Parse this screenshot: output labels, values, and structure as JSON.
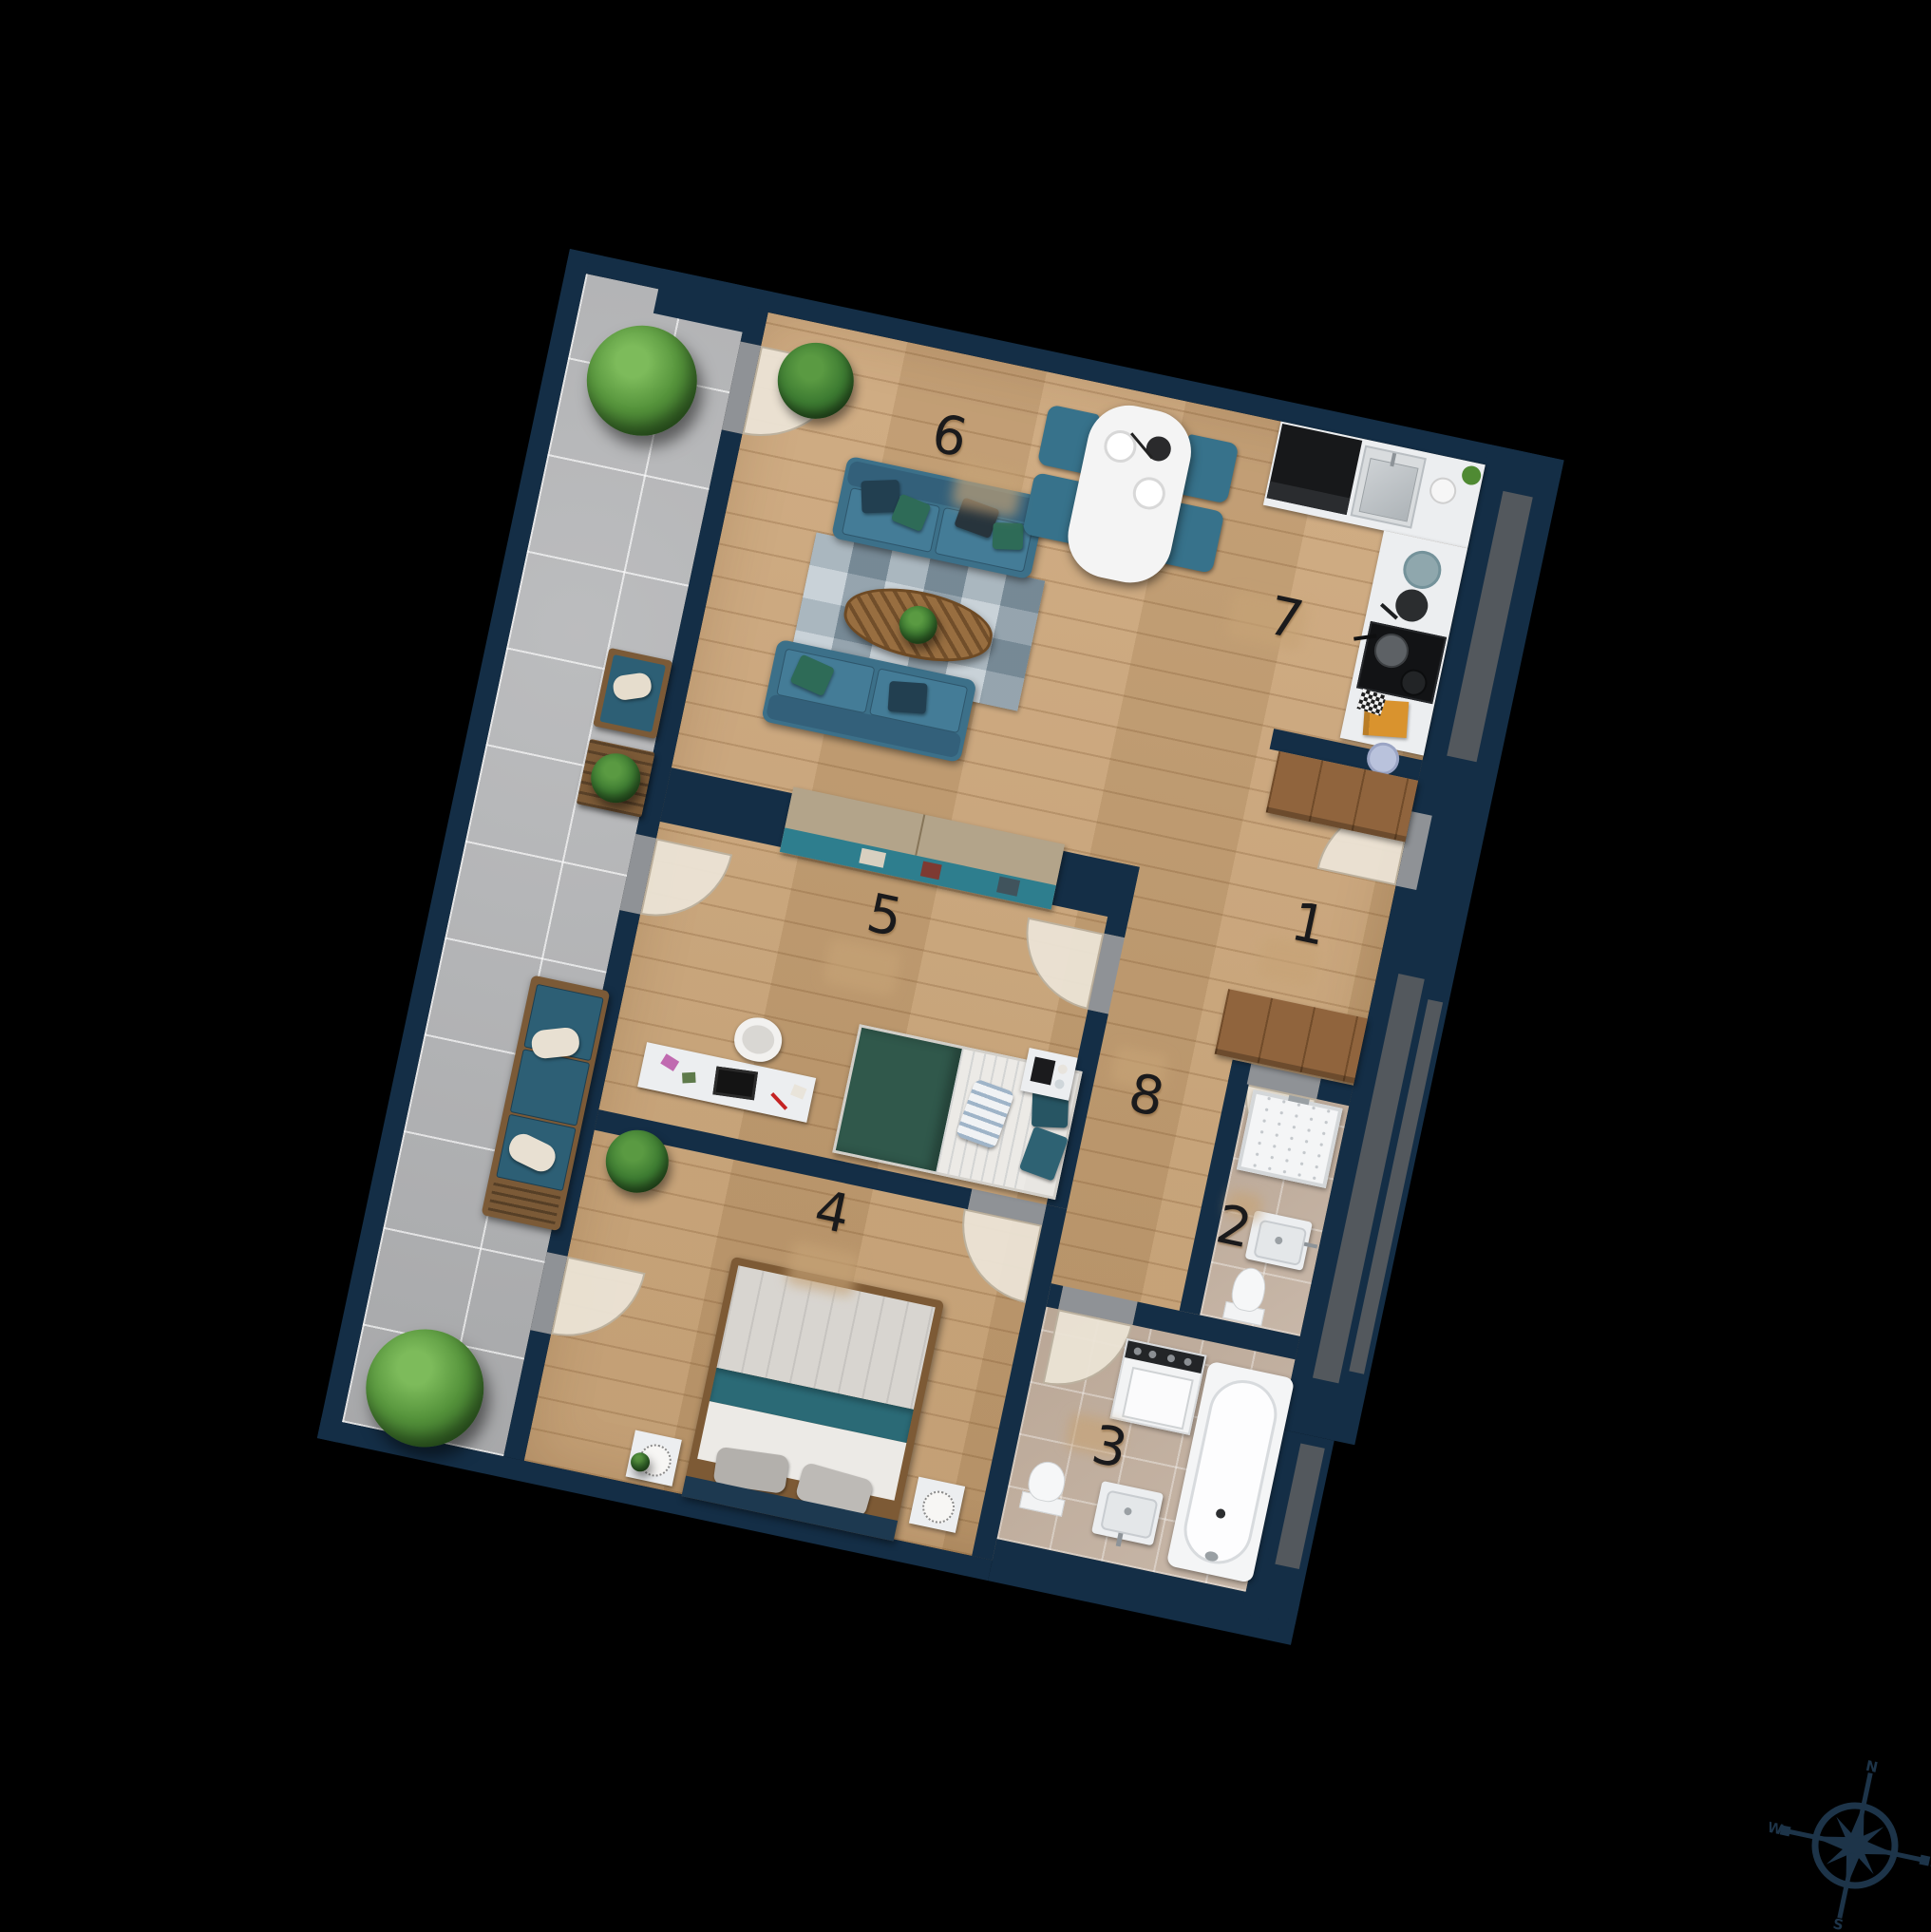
{
  "scene": {
    "background": "#000000",
    "type": "apartment-floor-plan"
  },
  "floorplan": {
    "rooms": [
      {
        "label": "1"
      },
      {
        "label": "2"
      },
      {
        "label": "3"
      },
      {
        "label": "4"
      },
      {
        "label": "5"
      },
      {
        "label": "6"
      },
      {
        "label": "7"
      },
      {
        "label": "8"
      }
    ]
  },
  "compass": {
    "north": "N",
    "east": "E",
    "south": "S",
    "west": "W"
  },
  "colors": {
    "wall": "#142e46",
    "woodFloor": "#c9a172",
    "balconyTile": "#b4b5b7",
    "bathTile": "#c3b1a1",
    "sofaTeal": "#3c7089",
    "outdoorTeal": "#2d5f75",
    "accentTeal": "#2e7e8e",
    "furnitureWood": "#8a5c33",
    "shaftGray": "#53585d",
    "doorArc": "#ece4d6",
    "greenBed": "#30584b",
    "bedTealStripe": "#2b6a76",
    "compassNavy": "#1d3449"
  }
}
